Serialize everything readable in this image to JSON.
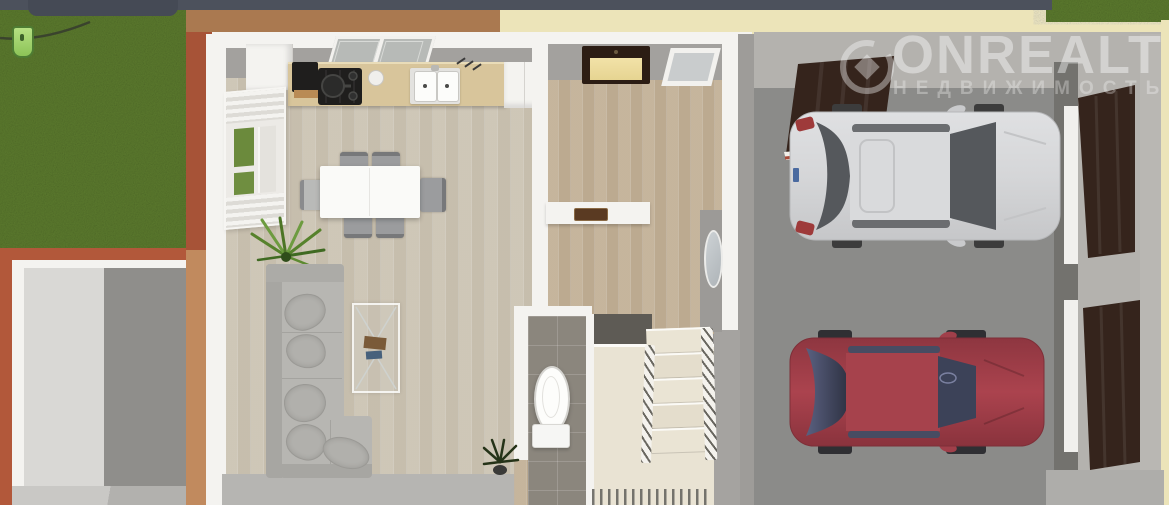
{
  "watermark": {
    "brand": "ONREALT",
    "subtitle": "НЕДВИЖИМОСТЬ",
    "logo_icon": "diamond-circle-logo"
  },
  "scene": {
    "view": "3d-floorplan-top-down",
    "areas": [
      "front-lawn",
      "side-storage-room",
      "kitchen",
      "dining-area",
      "living-room",
      "entry-hall",
      "corridor",
      "bathroom",
      "staircase",
      "garage"
    ],
    "objects": [
      "refrigerator",
      "range-hood",
      "gas-stove",
      "double-sink",
      "kitchen-counter",
      "window-blinds",
      "dining-table",
      "chairs",
      "corner-sofa",
      "throw-pillows",
      "glass-coffee-table",
      "palm-plant",
      "floor-plant",
      "front-door",
      "skylight-window",
      "wall-mirror",
      "doormat",
      "toilet",
      "stair-railings",
      "open-garage-door",
      "garage-side-doors"
    ],
    "vehicles": [
      {
        "name": "silver-car"
      },
      {
        "name": "red-car"
      }
    ]
  },
  "colors": {
    "top_bar": "#4c515c",
    "top_tab": "#454a55",
    "grass": "#5b7a2d",
    "exterior_brown": "#aa7950",
    "exterior_rust": "#b2583a",
    "exterior_tan": "#c18a5e",
    "exterior_cream": "#ece4b9",
    "wall_white": "#f4f3f0",
    "wall_gray": "#a3a19e",
    "floor_light": "#cdc5b5",
    "floor_warm": "#c2b198",
    "counter": "#d8c59b",
    "appliance_dark": "#1f1e1d",
    "hood_shelf": "#b98b55",
    "sofa": "#b7b6b2",
    "sofa_dark": "#a7a6a2",
    "table_white": "#fafaf8",
    "chair_gray": "#9b9c9e",
    "tile_gray": "#8b867d",
    "tile_dark": "#5e5b55",
    "stair_beige": "#e9e3d3",
    "garage_wall": "#b4b2ae",
    "garage_floor": "#8b8b89",
    "garage_shadow": "#73726e",
    "door_brown": "#35241c",
    "door_frame_white": "#f1f0ed",
    "car_silver": "#d5d6d8",
    "car_red": "#a03f4a",
    "glass_dark": "#55585c",
    "glass_blue": "#3c4258",
    "room_light_wall": "#d9d8d5",
    "room_dark_wall": "#8f8e8b",
    "bottom_band": "#b6b5b2",
    "marker_green": "#9ed06a",
    "watermark_strong": "rgba(255,255,255,0.42)",
    "watermark_soft": "rgba(255,255,255,0.30)"
  }
}
